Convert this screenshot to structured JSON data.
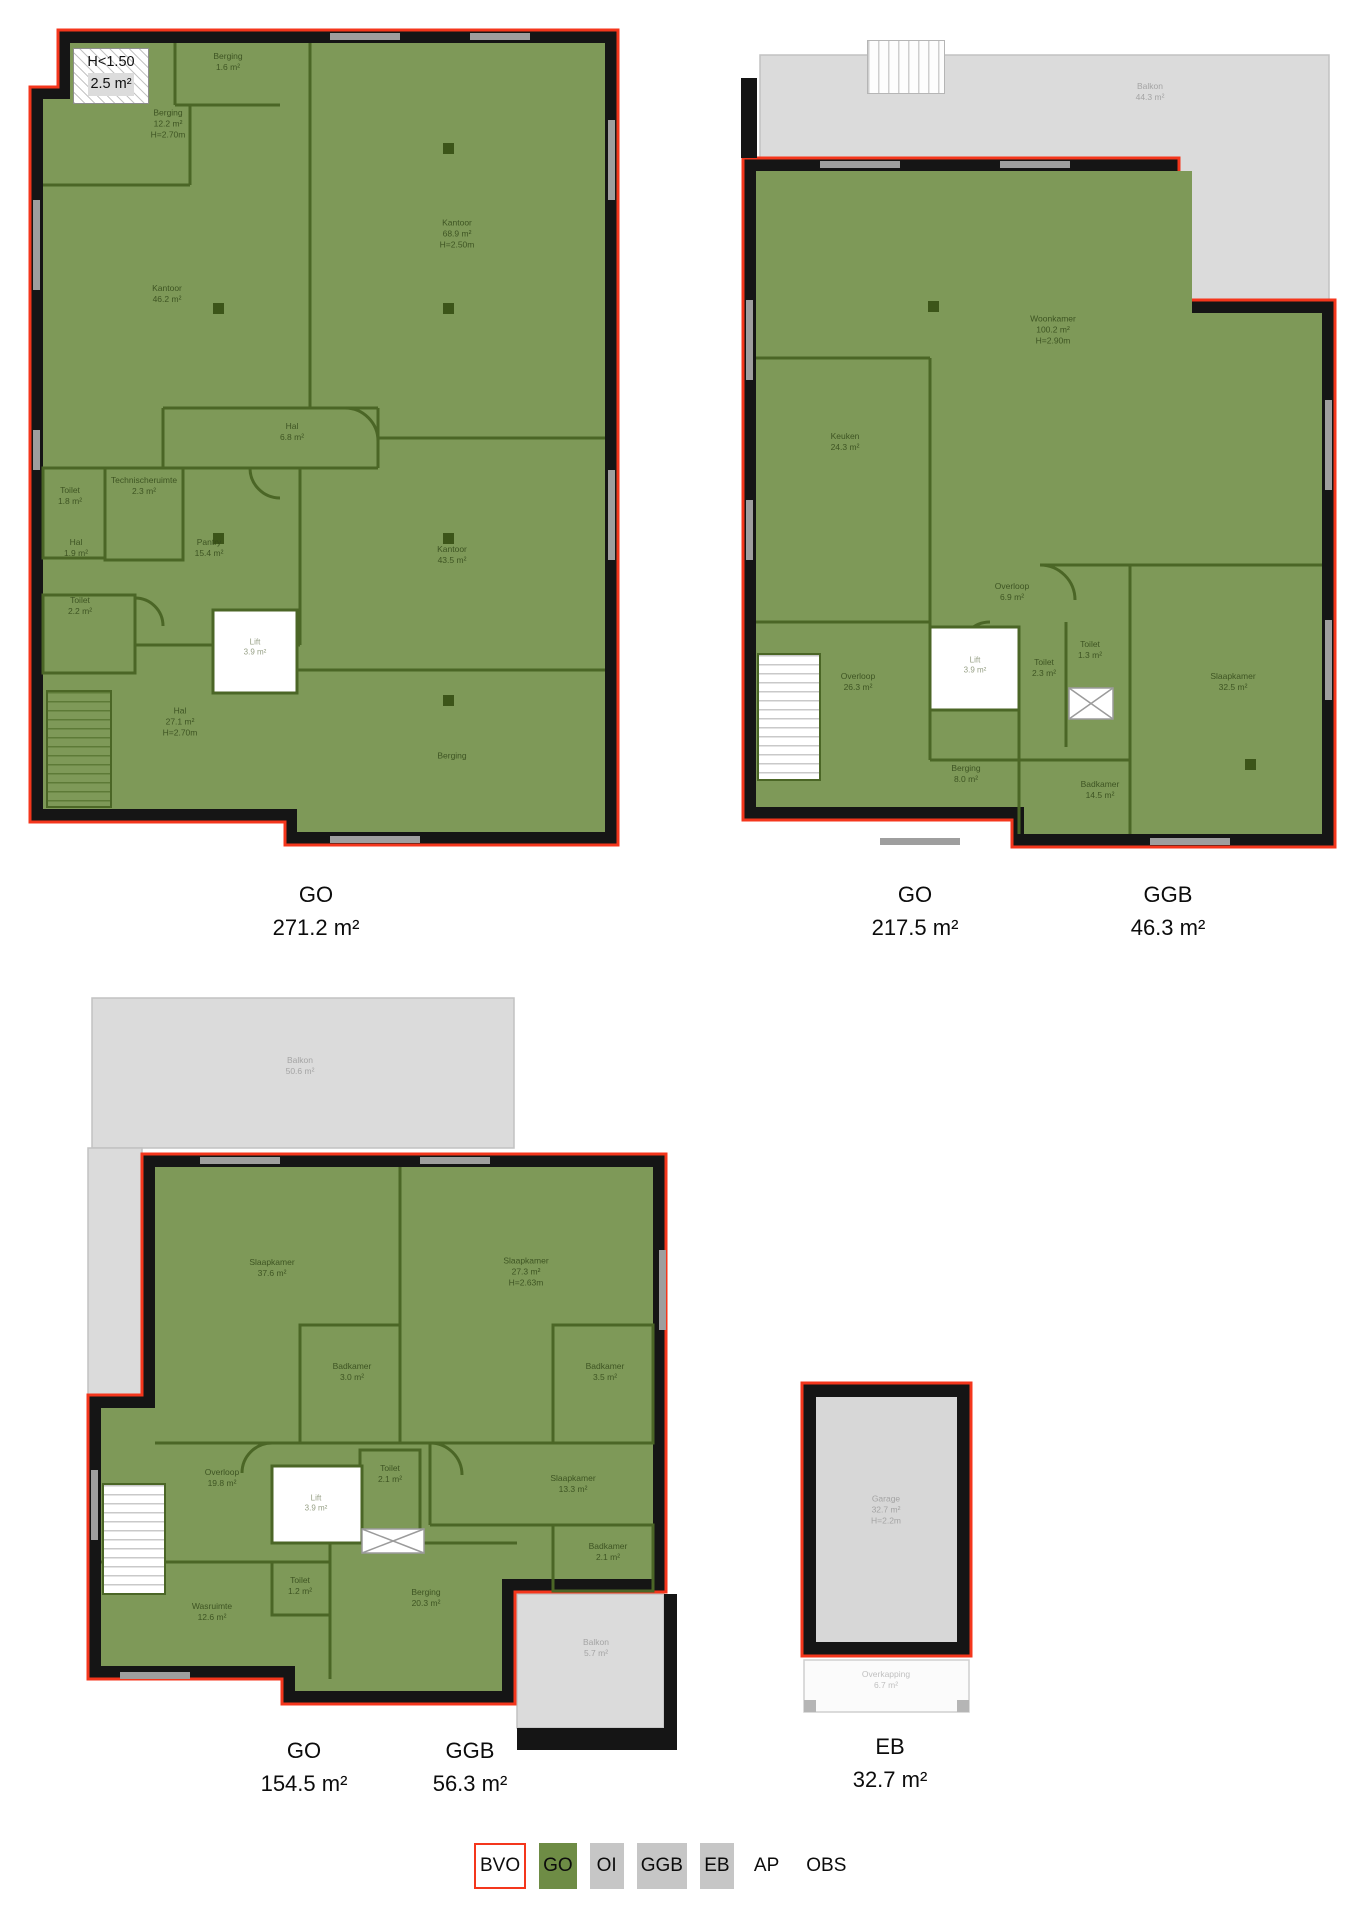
{
  "document_type": "NEN2580 floor plan measurement sheet",
  "colors": {
    "usable_area_green": "#7e9958",
    "wall_green": "#4b6626",
    "outer_wall_black": "#151515",
    "bvo_outline_red": "#f4361c",
    "balcony_grey": "#dbdbdb",
    "garage_grey": "#d7d7d7",
    "legend_chip_grey": "#c6c6c6"
  },
  "plans": [
    {
      "name": "floor-1",
      "attic_note": {
        "title": "H<1.50",
        "area": "2.5 m²"
      },
      "summary": [
        {
          "code": "GO",
          "area": "271.2 m²",
          "x": 316,
          "y": 878
        }
      ],
      "rooms": [
        {
          "label": "Berging",
          "area": "1.6 m²",
          "x": 228,
          "y": 62,
          "tone": "green"
        },
        {
          "label": "Berging",
          "area": "12.2 m²",
          "height": "H=2.70m",
          "x": 168,
          "y": 124,
          "tone": "green"
        },
        {
          "label": "Kantoor",
          "area": "46.2 m²",
          "x": 167,
          "y": 294,
          "tone": "green"
        },
        {
          "label": "Kantoor",
          "area": "68.9 m²",
          "height": "H=2.50m",
          "x": 457,
          "y": 234,
          "tone": "green"
        },
        {
          "label": "Hal",
          "area": "6.8 m²",
          "x": 292,
          "y": 432,
          "tone": "green"
        },
        {
          "label": "Technischeruimte",
          "area": "2.3 m²",
          "x": 144,
          "y": 486,
          "tone": "green"
        },
        {
          "label": "Toilet",
          "area": "1.8 m²",
          "x": 70,
          "y": 496,
          "tone": "green"
        },
        {
          "label": "Hal",
          "area": "1.9 m²",
          "x": 76,
          "y": 548,
          "tone": "green"
        },
        {
          "label": "Toilet",
          "area": "2.2 m²",
          "x": 80,
          "y": 606,
          "tone": "green"
        },
        {
          "label": "Pantry",
          "area": "15.4 m²",
          "x": 209,
          "y": 548,
          "tone": "green"
        },
        {
          "label": "Kantoor",
          "area": "43.5 m²",
          "x": 452,
          "y": 555,
          "tone": "green"
        },
        {
          "label": "Lift",
          "area": "3.9 m²",
          "x": 255,
          "y": 648,
          "tone": "lift"
        },
        {
          "label": "Hal",
          "area": "27.1 m²",
          "height": "H=2.70m",
          "x": 180,
          "y": 722,
          "tone": "green"
        },
        {
          "label": "Berging",
          "x": 452,
          "y": 756,
          "tone": "green"
        }
      ]
    },
    {
      "name": "floor-2",
      "summary": [
        {
          "code": "GO",
          "area": "217.5 m²",
          "x": 915,
          "y": 878
        },
        {
          "code": "GGB",
          "area": "46.3 m²",
          "x": 1168,
          "y": 878
        }
      ],
      "rooms": [
        {
          "label": "Balkon",
          "area": "44.3 m²",
          "x": 1150,
          "y": 92,
          "tone": "grey"
        },
        {
          "label": "Woonkamer",
          "area": "100.2 m²",
          "height": "H=2.90m",
          "x": 1053,
          "y": 330,
          "tone": "green"
        },
        {
          "label": "Keuken",
          "area": "24.3 m²",
          "x": 845,
          "y": 442,
          "tone": "green"
        },
        {
          "label": "Overloop",
          "area": "6.9 m²",
          "x": 1012,
          "y": 592,
          "tone": "green"
        },
        {
          "label": "Lift",
          "area": "3.9 m²",
          "x": 975,
          "y": 666,
          "tone": "lift"
        },
        {
          "label": "Toilet",
          "area": "2.3 m²",
          "x": 1044,
          "y": 668,
          "tone": "green"
        },
        {
          "label": "Toilet",
          "area": "1.3 m²",
          "x": 1090,
          "y": 650,
          "tone": "green"
        },
        {
          "label": "Slaapkamer",
          "area": "32.5 m²",
          "x": 1233,
          "y": 682,
          "tone": "green"
        },
        {
          "label": "Overloop",
          "area": "26.3 m²",
          "x": 858,
          "y": 682,
          "tone": "green"
        },
        {
          "label": "Berging",
          "area": "8.0 m²",
          "x": 966,
          "y": 774,
          "tone": "green"
        },
        {
          "label": "Badkamer",
          "area": "14.5 m²",
          "x": 1100,
          "y": 790,
          "tone": "green"
        }
      ]
    },
    {
      "name": "floor-3",
      "summary": [
        {
          "code": "GO",
          "area": "154.5 m²",
          "x": 304,
          "y": 1734
        },
        {
          "code": "GGB",
          "area": "56.3 m²",
          "x": 470,
          "y": 1734
        }
      ],
      "rooms": [
        {
          "label": "Balkon",
          "area": "50.6 m²",
          "x": 300,
          "y": 1066,
          "tone": "grey"
        },
        {
          "label": "Slaapkamer",
          "area": "37.6 m²",
          "x": 272,
          "y": 1268,
          "tone": "green"
        },
        {
          "label": "Slaapkamer",
          "area": "27.3 m²",
          "height": "H=2.63m",
          "x": 526,
          "y": 1272,
          "tone": "green"
        },
        {
          "label": "Badkamer",
          "area": "3.0 m²",
          "x": 352,
          "y": 1372,
          "tone": "green"
        },
        {
          "label": "Badkamer",
          "area": "3.5 m²",
          "x": 605,
          "y": 1372,
          "tone": "green"
        },
        {
          "label": "Overloop",
          "area": "19.8 m²",
          "x": 222,
          "y": 1478,
          "tone": "green"
        },
        {
          "label": "Lift",
          "area": "3.9 m²",
          "x": 316,
          "y": 1504,
          "tone": "lift"
        },
        {
          "label": "Toilet",
          "area": "2.1 m²",
          "x": 390,
          "y": 1474,
          "tone": "green"
        },
        {
          "label": "Slaapkamer",
          "area": "13.3 m²",
          "x": 573,
          "y": 1484,
          "tone": "green"
        },
        {
          "label": "Badkamer",
          "area": "2.1 m²",
          "x": 608,
          "y": 1552,
          "tone": "green"
        },
        {
          "label": "Toilet",
          "area": "1.2 m²",
          "x": 300,
          "y": 1586,
          "tone": "green"
        },
        {
          "label": "Wasruimte",
          "area": "12.6 m²",
          "x": 212,
          "y": 1612,
          "tone": "green"
        },
        {
          "label": "Berging",
          "area": "20.3 m²",
          "x": 426,
          "y": 1598,
          "tone": "green"
        },
        {
          "label": "Balkon",
          "area": "5.7 m²",
          "x": 596,
          "y": 1648,
          "tone": "grey"
        }
      ]
    },
    {
      "name": "external-storage",
      "summary": [
        {
          "code": "EB",
          "area": "32.7 m²",
          "x": 890,
          "y": 1730
        }
      ],
      "rooms": [
        {
          "label": "Garage",
          "area": "32.7 m²",
          "height": "H=2.2m",
          "x": 886,
          "y": 1510,
          "tone": "grey"
        },
        {
          "label": "Overkapping",
          "area": "6.7 m²",
          "x": 886,
          "y": 1680,
          "tone": "faint"
        }
      ]
    }
  ],
  "legend": {
    "items": [
      {
        "label": "BVO",
        "chip": "bvo"
      },
      {
        "label": "GO",
        "chip": "go"
      },
      {
        "label": "OI",
        "chip": "grey"
      },
      {
        "label": "GGB",
        "chip": "grey"
      },
      {
        "label": "EB",
        "chip": "grey"
      },
      {
        "label": "AP",
        "chip": "none"
      },
      {
        "label": "OBS",
        "chip": "none"
      }
    ]
  }
}
